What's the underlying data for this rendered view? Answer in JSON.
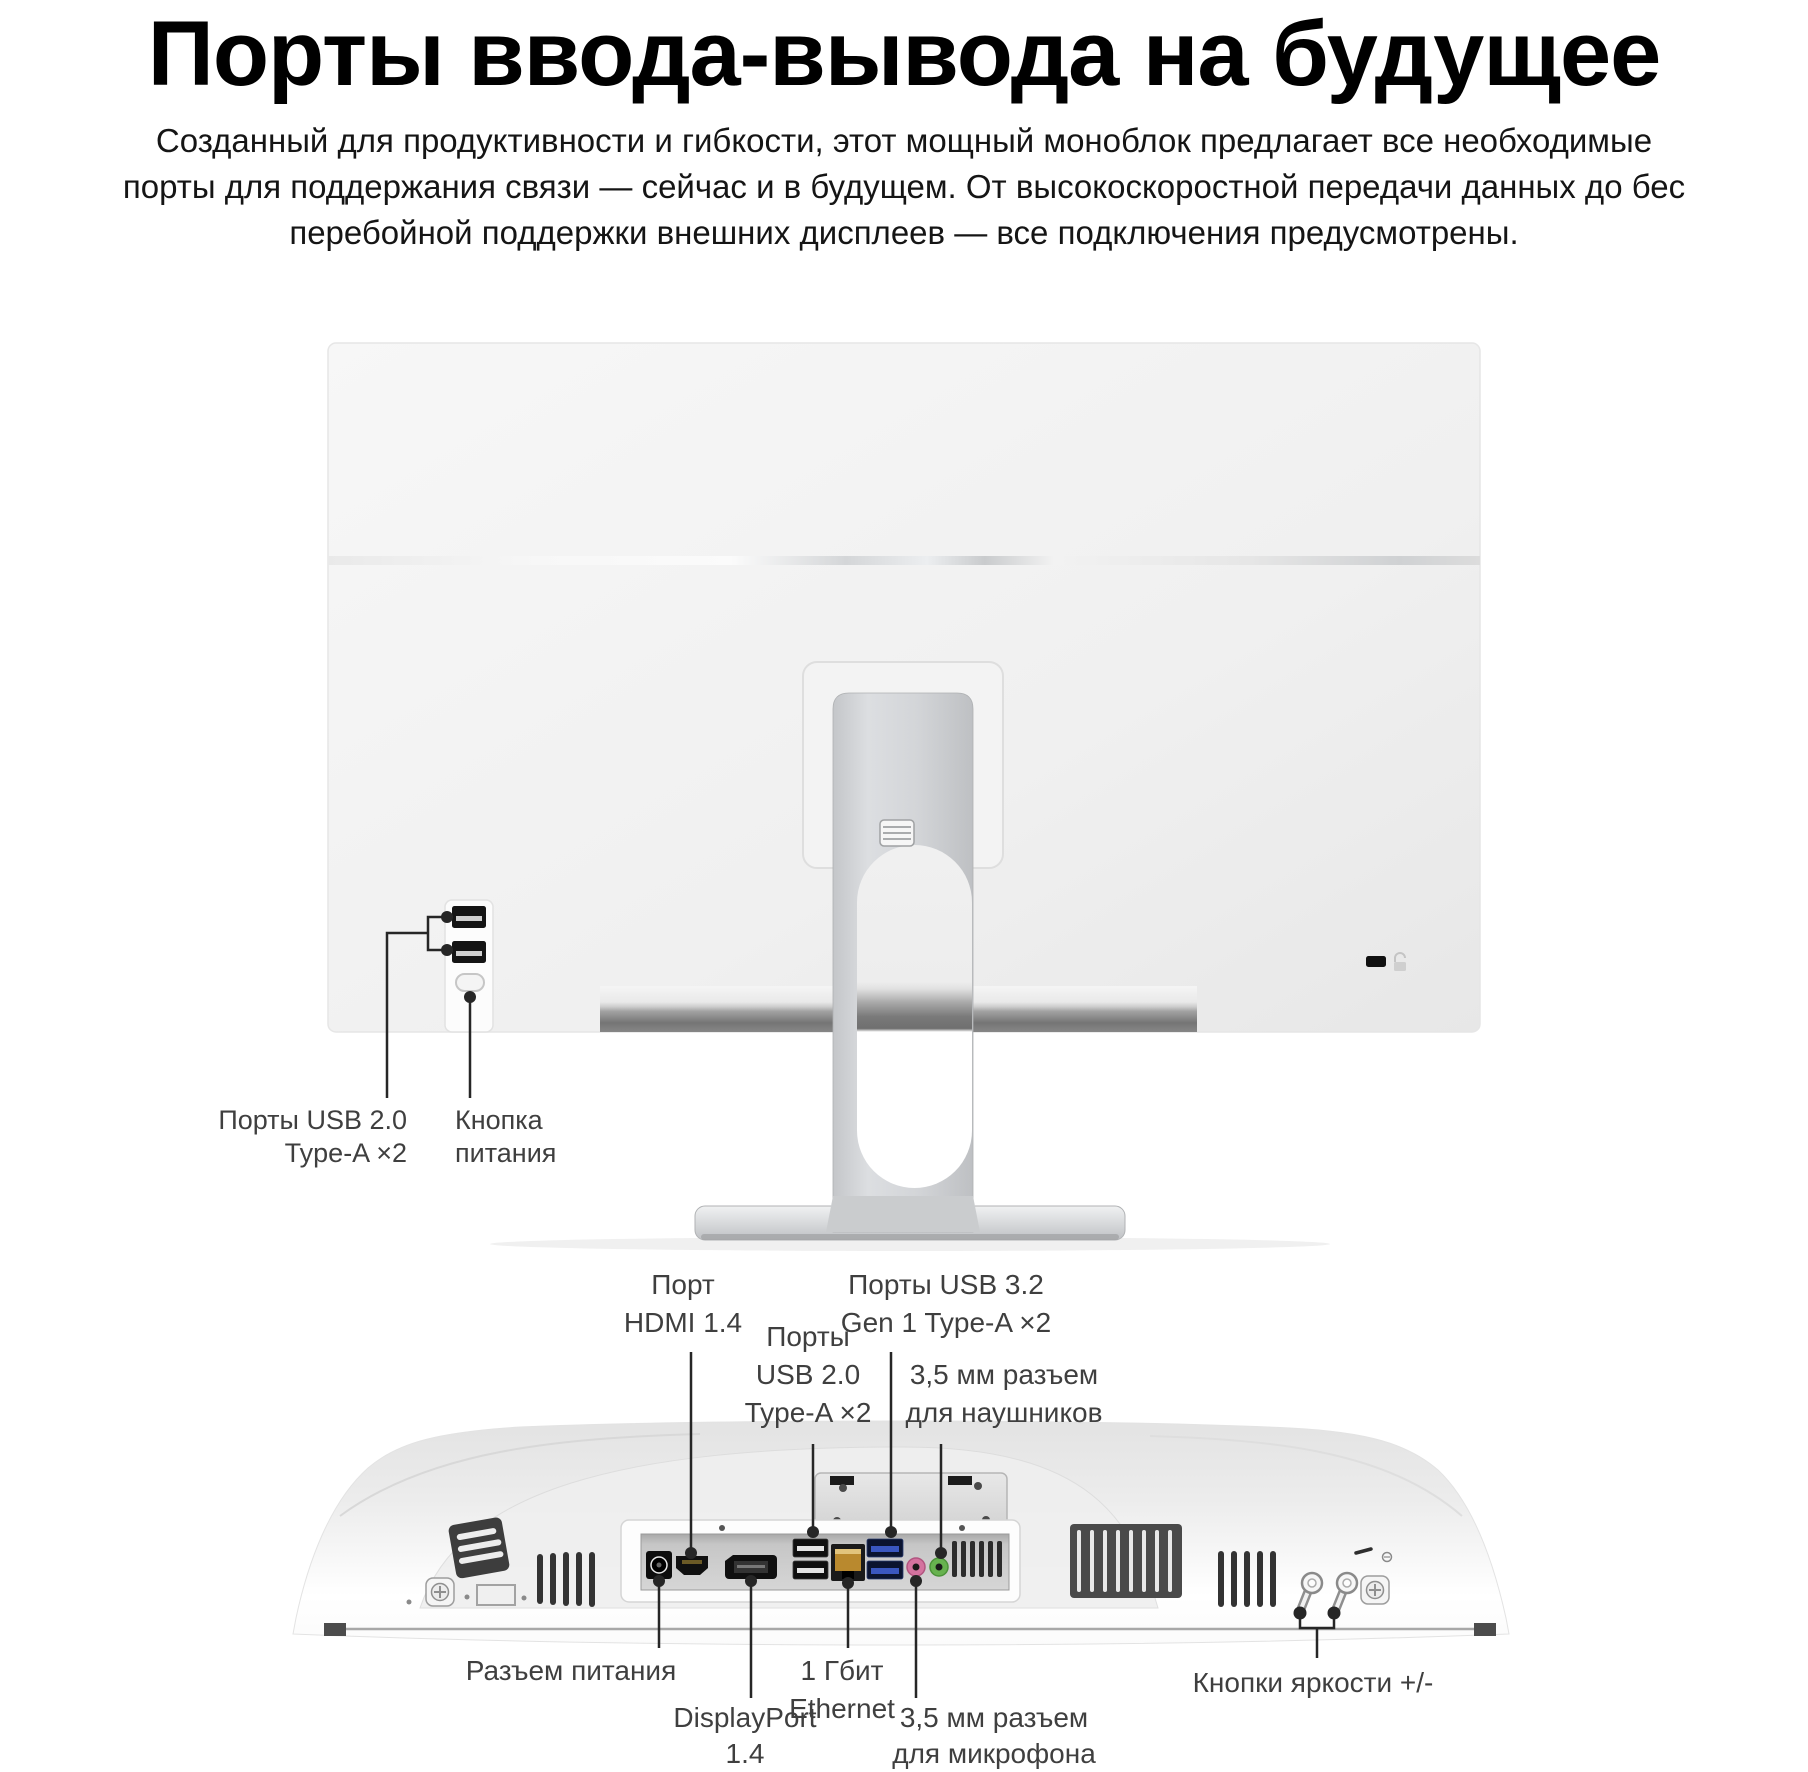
{
  "header": {
    "title": "Порты ввода-вывода на будущее",
    "intro_lines": [
      "Созданный для продуктивности и гибкости, этот мощный моноблок предлагает все необходимые",
      "порты для поддержания связи — сейчас и в будущем. От высокоскоростной передачи данных до бес",
      "перебойной поддержки внешних дисплеев — все подключения предусмотрены."
    ]
  },
  "back_view": {
    "usb_label_lines": [
      "Порты USB 2.0",
      "Type-A ×2"
    ],
    "power_label_lines": [
      "Кнопка",
      "питания"
    ],
    "ports": [
      "usb2-typea",
      "usb2-typea",
      "power-button",
      "kensington-lock-slot"
    ]
  },
  "bottom_view": {
    "hdmi_lines": [
      "Порт",
      "HDMI 1.4"
    ],
    "usb2_lines": [
      "Порты",
      "USB 2.0",
      "Type-A ×2"
    ],
    "usb3_lines": [
      "Порты USB 3.2",
      "Gen 1 Type-A ×2"
    ],
    "headphone_lines": [
      "3,5 мм разъем",
      "для наушников"
    ],
    "power_line": "Разъем питания",
    "ethernet_lines": [
      "1 Гбит",
      "Ethernet"
    ],
    "displayport_lines": [
      "DisplayPort",
      "1.4"
    ],
    "mic_lines": [
      "3,5 мм разъем",
      "для микрофона"
    ],
    "brightness_line": "Кнопки яркости +/-",
    "ports": [
      "dc-power",
      "hdmi",
      "displayport",
      "usb2-typea",
      "usb2-typea",
      "ethernet-rj45",
      "usb3-typea",
      "usb3-typea",
      "mic-jack-3.5mm",
      "headphone-jack-3.5mm",
      "brightness-buttons"
    ]
  },
  "colors": {
    "usb3_blue": "#3a57c0",
    "usb3_shell": "#0b1430",
    "mic_pink": "#d4739f",
    "headphone_green": "#67b24f",
    "ethernet_amber": "#b9892e",
    "callout_line": "#262626",
    "label_text": "#3f3f3f",
    "title_text": "#000000"
  }
}
